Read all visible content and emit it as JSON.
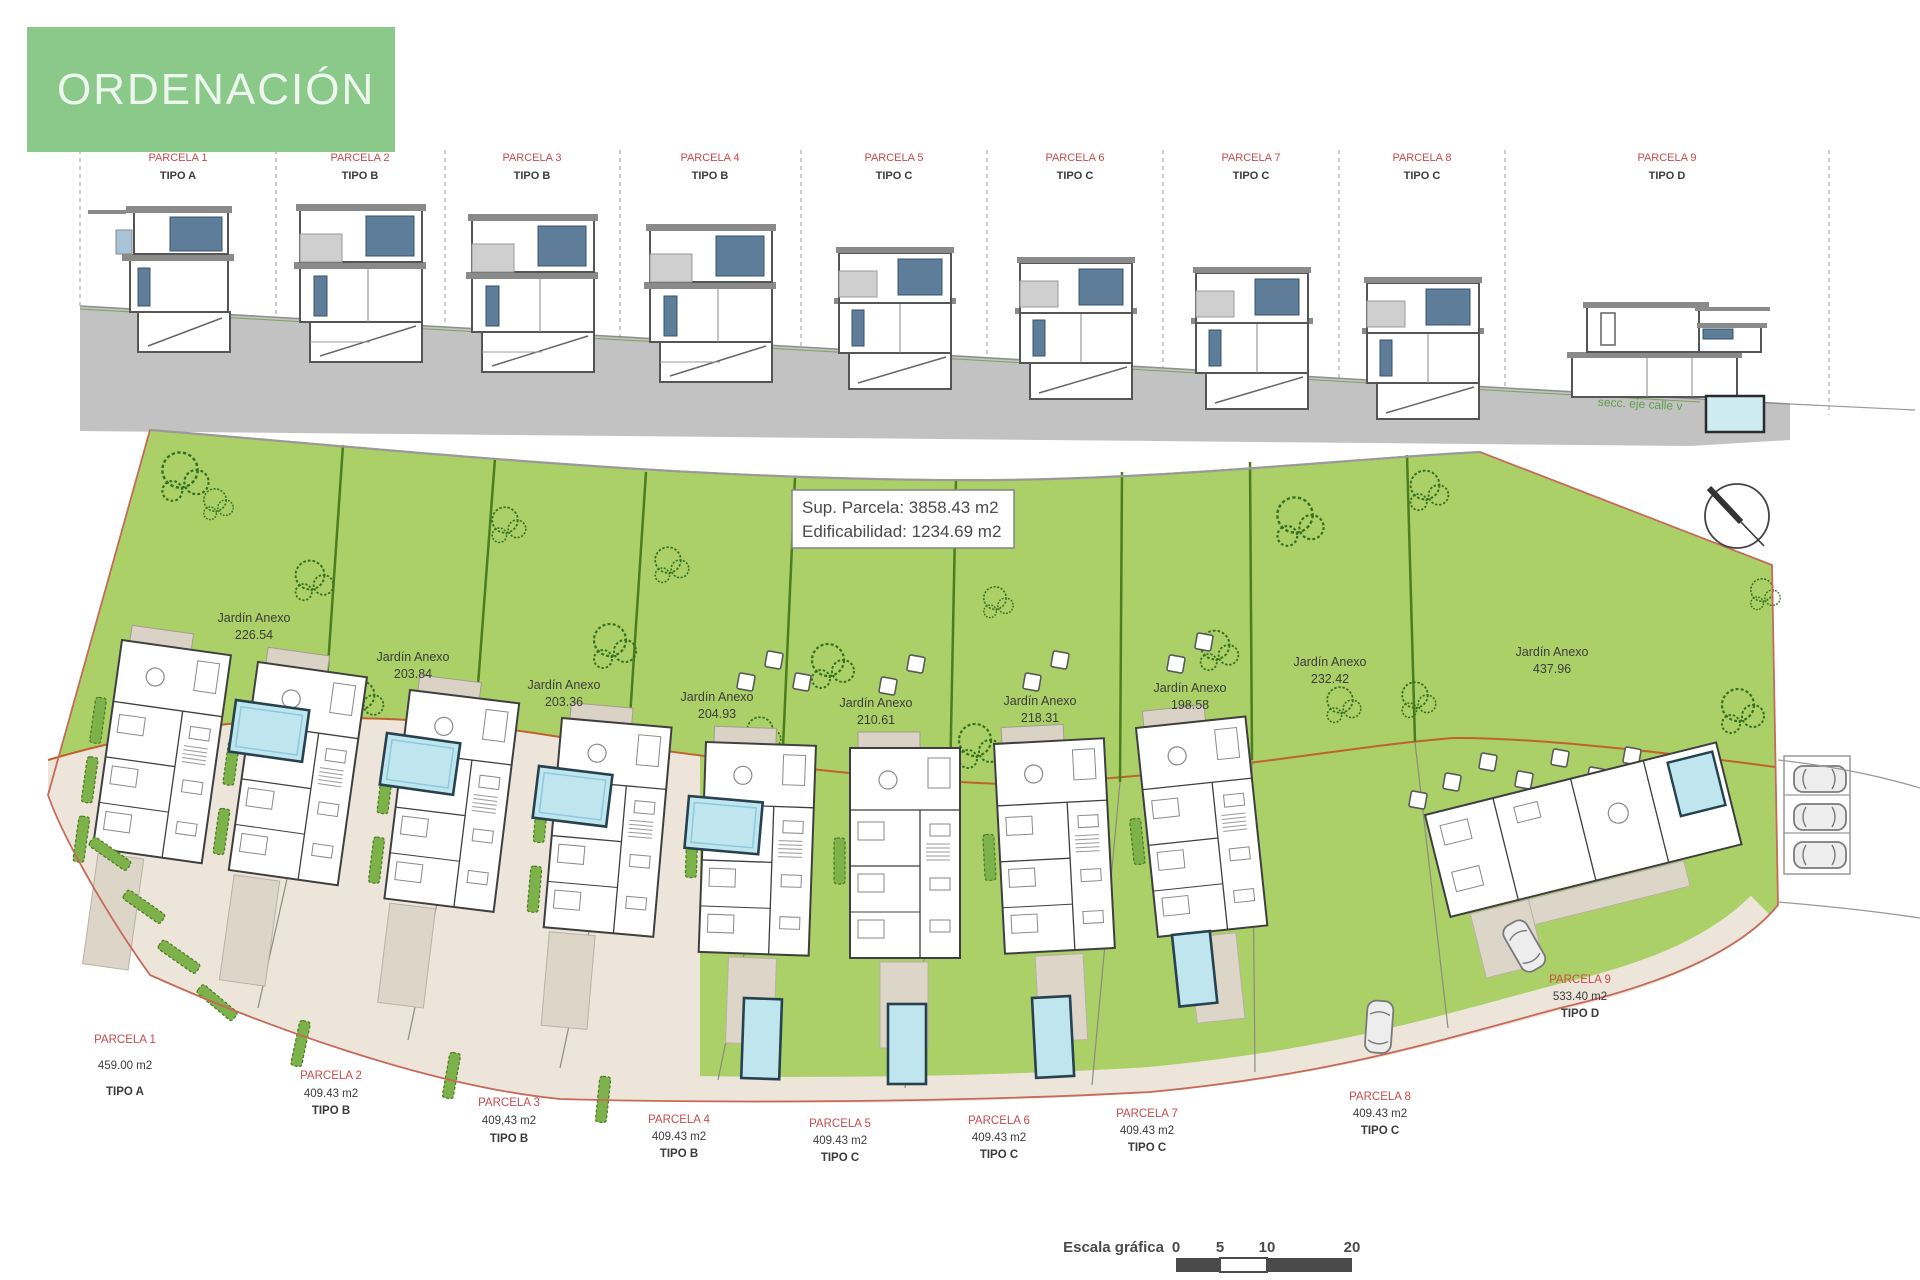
{
  "banner": {
    "title": "ORDENACIÓN"
  },
  "section_view": {
    "parcels": [
      {
        "name": "PARCELA 1",
        "tipo": "TIPO A"
      },
      {
        "name": "PARCELA 2",
        "tipo": "TIPO B"
      },
      {
        "name": "PARCELA 3",
        "tipo": "TIPO B"
      },
      {
        "name": "PARCELA 4",
        "tipo": "TIPO B"
      },
      {
        "name": "PARCELA 5",
        "tipo": "TIPO C"
      },
      {
        "name": "PARCELA 6",
        "tipo": "TIPO C"
      },
      {
        "name": "PARCELA 7",
        "tipo": "TIPO C"
      },
      {
        "name": "PARCELA 8",
        "tipo": "TIPO C"
      },
      {
        "name": "PARCELA 9",
        "tipo": "TIPO D"
      }
    ],
    "note": "secc. eje calle v"
  },
  "site_plan": {
    "info_box": {
      "line1": "Sup. Parcela:  3858.43 m2",
      "line2": "Edificabilidad: 1234.69 m2"
    },
    "gardens": [
      {
        "label": "Jardín Anexo",
        "area": "226.54"
      },
      {
        "label": "Jardín Anexo",
        "area": "203.84"
      },
      {
        "label": "Jardín Anexo",
        "area": "203.36"
      },
      {
        "label": "Jardín Anexo",
        "area": "204.93"
      },
      {
        "label": "Jardín Anexo",
        "area": "210.61"
      },
      {
        "label": "Jardín Anexo",
        "area": "218.31"
      },
      {
        "label": "Jardín Anexo",
        "area": "198.58"
      },
      {
        "label": "Jardín Anexo",
        "area": "232.42"
      },
      {
        "label": "Jardín Anexo",
        "area": "437.96"
      }
    ],
    "parcel_labels": [
      {
        "name": "PARCELA 1",
        "area": "459.00 m2",
        "tipo": "TIPO A"
      },
      {
        "name": "PARCELA 2",
        "area": "409.43 m2",
        "tipo": "TIPO B"
      },
      {
        "name": "PARCELA 3",
        "area": "409,43 m2",
        "tipo": "TIPO B"
      },
      {
        "name": "PARCELA 4",
        "area": "409.43 m2",
        "tipo": "TIPO B"
      },
      {
        "name": "PARCELA 5",
        "area": "409.43 m2",
        "tipo": "TIPO C"
      },
      {
        "name": "PARCELA 6",
        "area": "409.43 m2",
        "tipo": "TIPO C"
      },
      {
        "name": "PARCELA 7",
        "area": "409.43 m2",
        "tipo": "TIPO C"
      },
      {
        "name": "PARCELA 8",
        "area": "409.43 m2",
        "tipo": "TIPO C"
      },
      {
        "name": "PARCELA 9",
        "area": "533.40 m2",
        "tipo": "TIPO D"
      }
    ],
    "scale_bar": {
      "label": "Escala gráfica",
      "tick0": "0",
      "tick1": "5",
      "tick2": "10",
      "tick3": "20"
    }
  },
  "colors": {
    "banner_green": "#8BC98B",
    "label_red": "#C84B4B",
    "plan_green": "#ABD068",
    "pool_blue": "#BFE6EF",
    "ground_gray": "#C2C2C2",
    "boundary_red": "#C66A5A"
  }
}
